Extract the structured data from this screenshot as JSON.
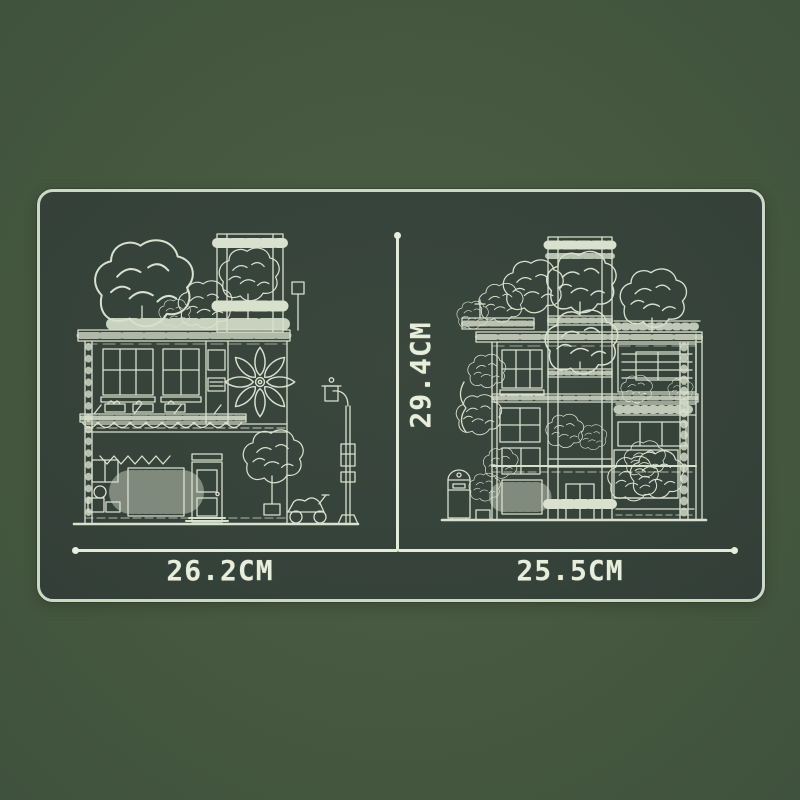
{
  "panel": {
    "name": "product-size-blueprint-panel",
    "dimension_labels": {
      "left_width": "26.2CM",
      "right_width": "25.5CM",
      "height": "29.4CM"
    },
    "figures": {
      "left": "building-front-elevation-blueprint",
      "right": "building-side-elevation-blueprint"
    }
  },
  "colors": {
    "background": "#46583F",
    "panel_fill": "#35423A",
    "panel_border": "#CCD8C6",
    "line_art": "#E2E9D6",
    "label_text": "#E8EEDC"
  }
}
